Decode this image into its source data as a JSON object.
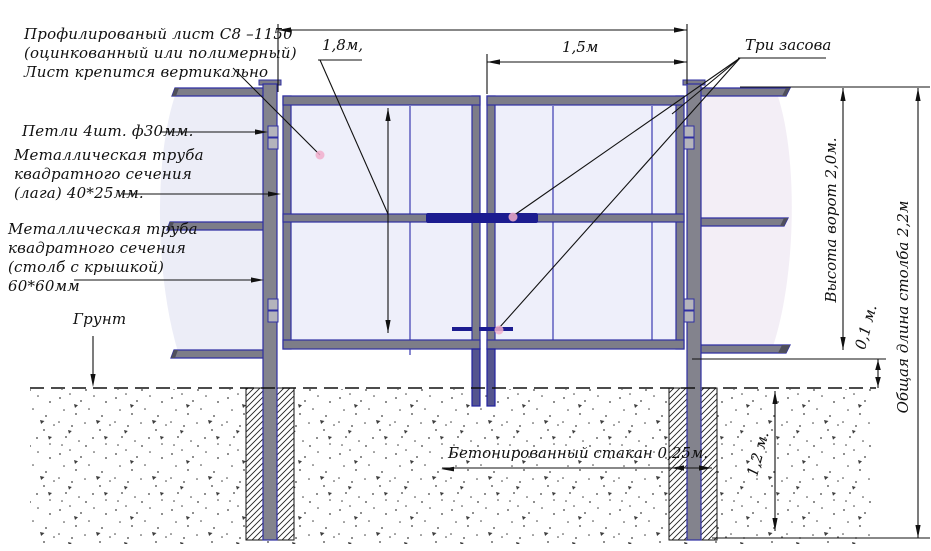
{
  "labels": {
    "sheet": [
      "Профилированый лист С8 –1150",
      "(оцинкованный или полимерный)",
      "Лист крепится вертикально"
    ],
    "hinges": "Петли 4шт. ф30мм.",
    "lag": [
      "Металлическая труба",
      "квадратного сечения",
      "(лага) 40*25мм."
    ],
    "post": [
      "Металлическая труба",
      "квадратного сечения",
      "(столб с крышкой)",
      "60*60мм"
    ],
    "ground": "Грунт",
    "latches": "Три засова",
    "foundation": "Бетонированный стакан 0,25м."
  },
  "dimensions": {
    "leaf_height": "1,8м,",
    "leaf_width": "1,5м",
    "gate_height": "Высота ворот 2,0м.",
    "post_total_length": "Общая длина столба 2,2м",
    "ground_clearance": "0,1 м.",
    "foundation_depth": "1,2 м."
  },
  "colors": {
    "frame_fill": "#7d7d88",
    "frame_outline": "#2f2fa2",
    "latch": "#1c1c90",
    "sheet_left": "#ecedf7",
    "sheet_right": "#f3eef6",
    "leaf_fill": "#eeeffa",
    "leader_dot": "#f1aecb"
  }
}
